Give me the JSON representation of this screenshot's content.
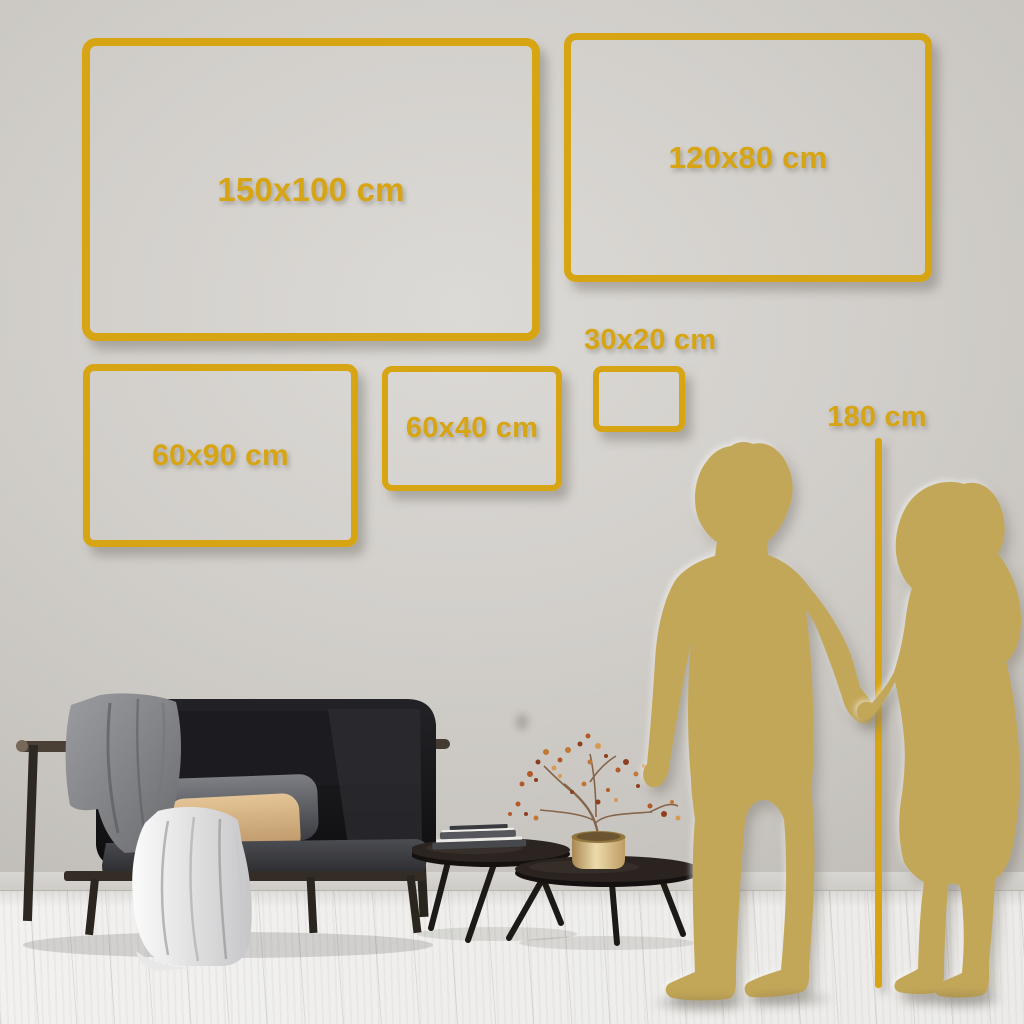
{
  "size_guide": {
    "frames": [
      {
        "label": "150x100 cm"
      },
      {
        "label": "120x80 cm"
      },
      {
        "label": "60x90 cm"
      },
      {
        "label": "60x40 cm"
      },
      {
        "label": "30x20 cm"
      }
    ],
    "height_reference": {
      "label": "180 cm"
    }
  },
  "colors": {
    "accent_gold": "#D7A513",
    "silhouette_gold": "#C3A758",
    "wall_gray": "#CDCAC5",
    "floor_white": "#F0EFED"
  },
  "scene": {
    "figures": "couple-silhouette",
    "furniture": [
      "black-sofa",
      "nesting-coffee-tables",
      "brass-vase-with-dried-plant"
    ]
  }
}
